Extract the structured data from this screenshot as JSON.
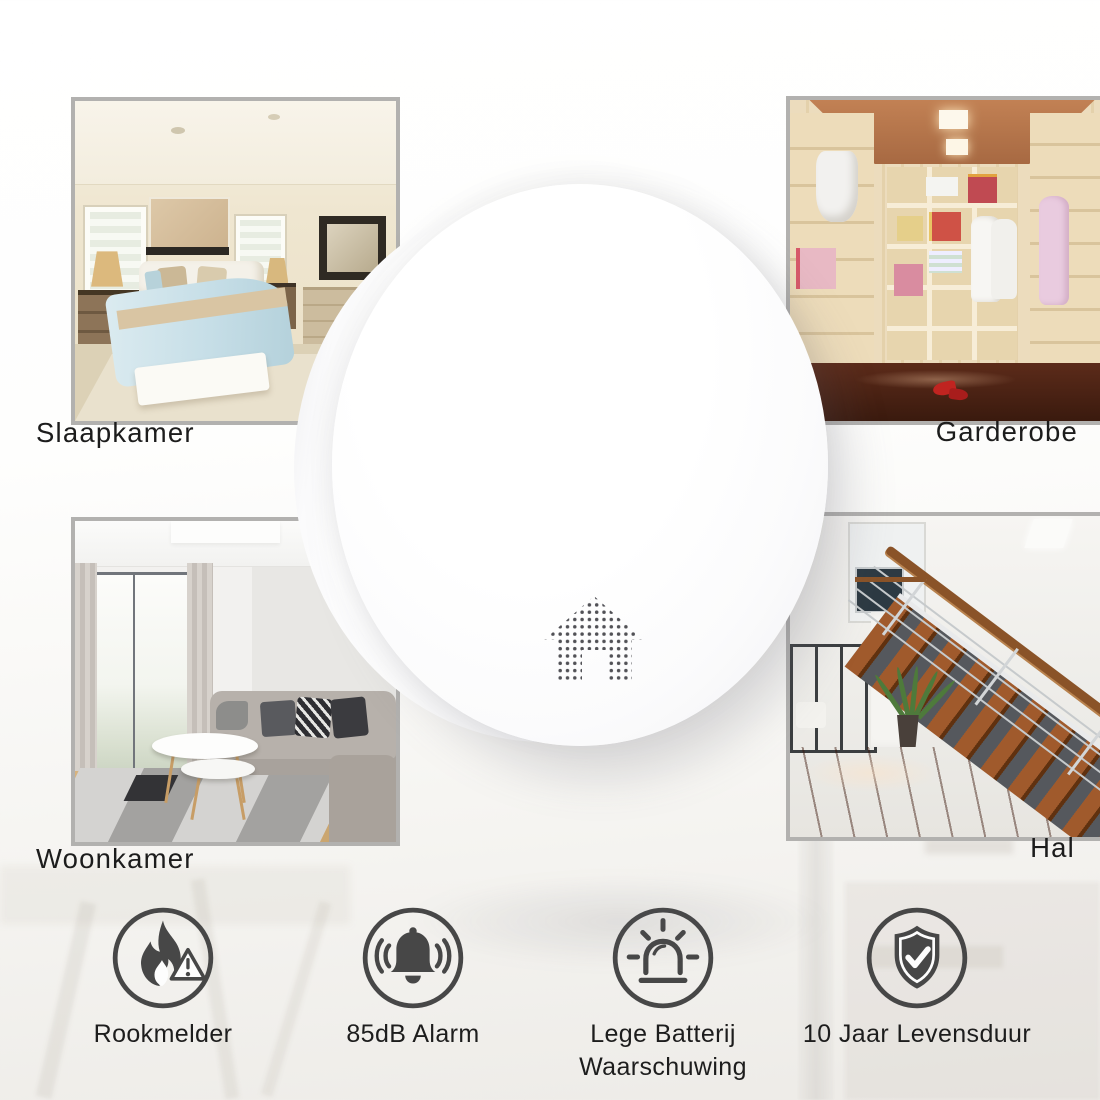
{
  "rooms": [
    {
      "name": "slaapkamer",
      "label": "Slaapkamer"
    },
    {
      "name": "garderobe",
      "label": "Garderobe"
    },
    {
      "name": "woonkamer",
      "label": "Woonkamer"
    },
    {
      "name": "hal",
      "label": "Hal"
    }
  ],
  "detector": {
    "icon": "house-dots-icon"
  },
  "features": [
    {
      "icon": "flame-warning-icon",
      "label": "Rookmelder"
    },
    {
      "icon": "alarm-bell-icon",
      "label": "85dB Alarm"
    },
    {
      "icon": "siren-beacon-icon",
      "label_line1": "Lege Batterij",
      "label_line2": "Waarschuwing"
    },
    {
      "icon": "shield-check-icon",
      "label": "10 Jaar Levensduur"
    }
  ],
  "colors": {
    "icon_gray": "#474747",
    "text_black": "#1c1c1c",
    "photo_border": "#b2b1af",
    "detector_white": "#ffffff"
  }
}
